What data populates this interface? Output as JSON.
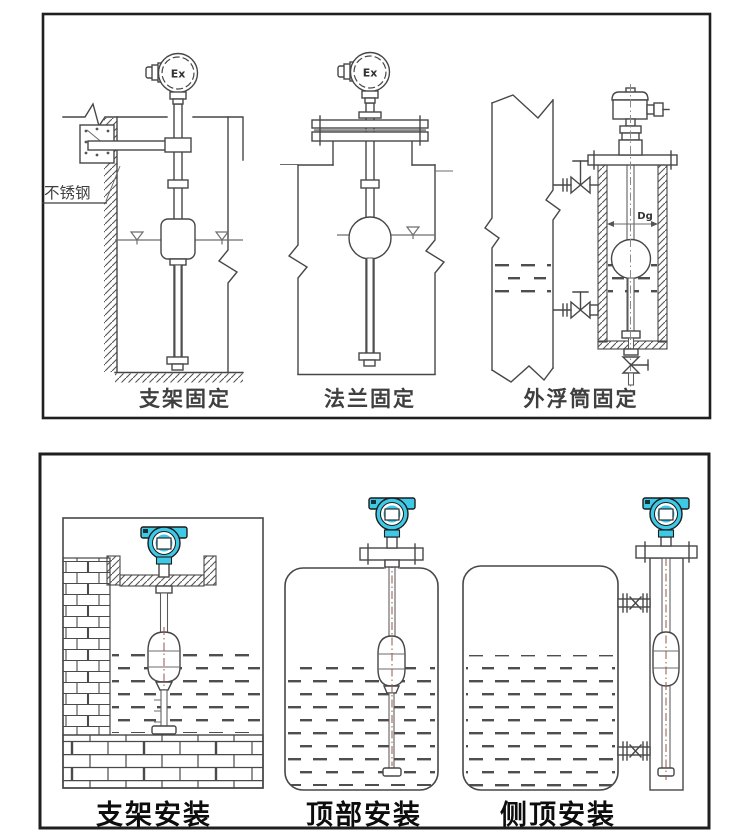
{
  "figure": {
    "top_panel": {
      "captions": [
        {
          "text": "支架固定"
        },
        {
          "text": "法兰固定"
        },
        {
          "text": "外浮筒固定"
        }
      ],
      "stainless_steel_label": "不锈钢",
      "ex_marking": "Ex",
      "diameter_label": "Dg"
    },
    "bottom_panel": {
      "captions": [
        {
          "text": "支架安装"
        },
        {
          "text": "顶部安装"
        },
        {
          "text": "侧顶安装"
        }
      ]
    },
    "colors": {
      "transmitter_housing_teal": "#3EC9E6",
      "drawing_line": "#474747",
      "caption_text": "#111111"
    }
  }
}
